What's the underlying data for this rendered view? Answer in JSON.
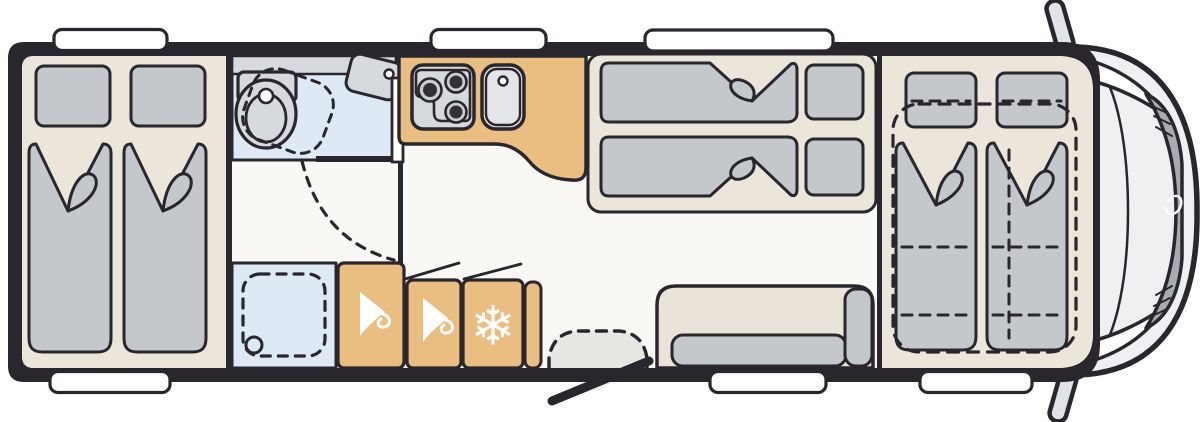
{
  "meta": {
    "label": "Motorhome floor plan, top-down view"
  },
  "colors": {
    "outline": "#2a262e",
    "floor": "#faf8f4",
    "wood": "#ebe6d9",
    "cushion": "#c4c7cb",
    "bath": "#dde9f4",
    "fixture": "#d6d9dd",
    "cabinet": "#eabd80",
    "sofa_back": "#e9e4d7",
    "cab_body": "#eef0f1",
    "windshield": "#a6acb2",
    "mirror": "#e0e4e8",
    "step": "#e9e7e3",
    "white": "#ffffff"
  },
  "icons": {
    "wardrobe_icon": "hanger-icon",
    "fridge_icon": "snowflake-icon",
    "fridge_glyph": "❄"
  },
  "zones": [
    {
      "id": "rear-twin-beds",
      "kind": "bedroom",
      "beds": 2
    },
    {
      "id": "washroom",
      "kind": "bathroom",
      "fixtures": [
        "swivel-toilet",
        "corner-sink"
      ]
    },
    {
      "id": "shower",
      "kind": "shower",
      "fixtures": [
        "drain"
      ]
    },
    {
      "id": "kitchen",
      "kind": "kitchen",
      "fixtures": [
        "three-burner-stove",
        "sink"
      ]
    },
    {
      "id": "storage-row",
      "kind": "storage",
      "units": [
        "wardrobe",
        "wardrobe",
        "fridge"
      ]
    },
    {
      "id": "mid-double-beds",
      "kind": "bedroom",
      "beds": 2
    },
    {
      "id": "lounge-sofa",
      "kind": "seating"
    },
    {
      "id": "entry-door",
      "kind": "entrance"
    },
    {
      "id": "front-drop-down-beds",
      "kind": "bedroom",
      "beds": 2
    },
    {
      "id": "driver-cab",
      "kind": "cab"
    }
  ],
  "windows": {
    "top": 3,
    "bottom": 3
  }
}
